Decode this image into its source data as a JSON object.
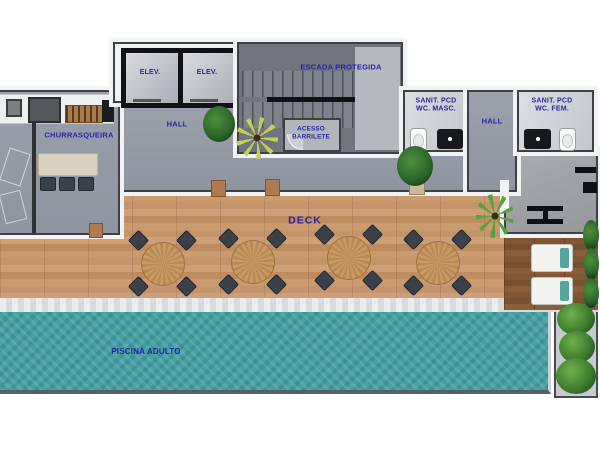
{
  "floor_plan": {
    "labels": {
      "elevator_1": "ELEV.",
      "elevator_2": "ELEV.",
      "elevator_hall": "HALL",
      "protected_staircase": "ESCADA PROTEGIDA",
      "barrilete_access_line1": "ACESSO",
      "barrilete_access_line2": "BARRILETE",
      "barbecue_area": "CHURRASQUEIRA",
      "accessible_wc_male_line1": "SANIT. PCD",
      "accessible_wc_male_line2": "WC. MASC.",
      "wc_hall": "HALL",
      "accessible_wc_female_line1": "SANIT. PCD",
      "accessible_wc_female_line2": "WC. FEM.",
      "deck": "DECK",
      "adult_pool": "PISCINA ADULTO"
    },
    "colors": {
      "label_text": "#2326a8",
      "pool_water": "#45a1a3",
      "deck_wood": "#c69468",
      "dark_deck_wood": "#7f5433",
      "corridor_gray": "#9ca1ab",
      "wall_dark": "#3f4045",
      "wall_white": "#f1f2f4"
    }
  }
}
